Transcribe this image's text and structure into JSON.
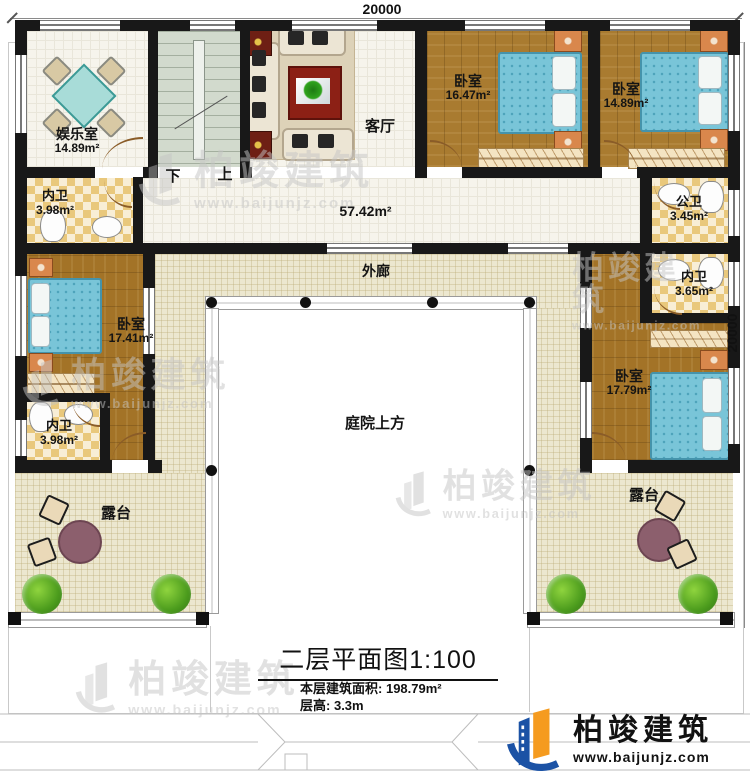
{
  "plan": {
    "dim_top": "20000",
    "dim_right": "20000",
    "rooms": {
      "yuleshi": {
        "name": "娱乐室",
        "area": "14.89m²"
      },
      "neiwei_tl": {
        "name": "内卫",
        "area": "3.98m²"
      },
      "keting": {
        "name": "客厅"
      },
      "hall_area": "57.42m²",
      "woshi1": {
        "name": "卧室",
        "area": "16.47m²"
      },
      "woshi2": {
        "name": "卧室",
        "area": "14.89m²"
      },
      "gongwei": {
        "name": "公卫",
        "area": "3.45m²"
      },
      "woshi_l": {
        "name": "卧室",
        "area": "17.41m²"
      },
      "neiwei_l": {
        "name": "内卫",
        "area": "3.98m²"
      },
      "neiwei_r": {
        "name": "内卫",
        "area": "3.65m²"
      },
      "woshi_r": {
        "name": "卧室",
        "area": "17.79m²"
      },
      "wailang": "外廊",
      "tingyuan": "庭院上方",
      "lutai_l": "露台",
      "lutai_r": "露台"
    },
    "stairs": {
      "down": "下",
      "up": "上"
    }
  },
  "titleblock": {
    "title": "二层平面图",
    "scale": "1:100",
    "area_label": "本层建筑面积:",
    "area_value": "198.79m²",
    "height_label": "层高:",
    "height_value": "3.3m"
  },
  "brand": {
    "name": "柏竣建筑",
    "url": "www.baijunjz.com",
    "blue": "#1b52a5",
    "orange": "#f59b1f"
  }
}
